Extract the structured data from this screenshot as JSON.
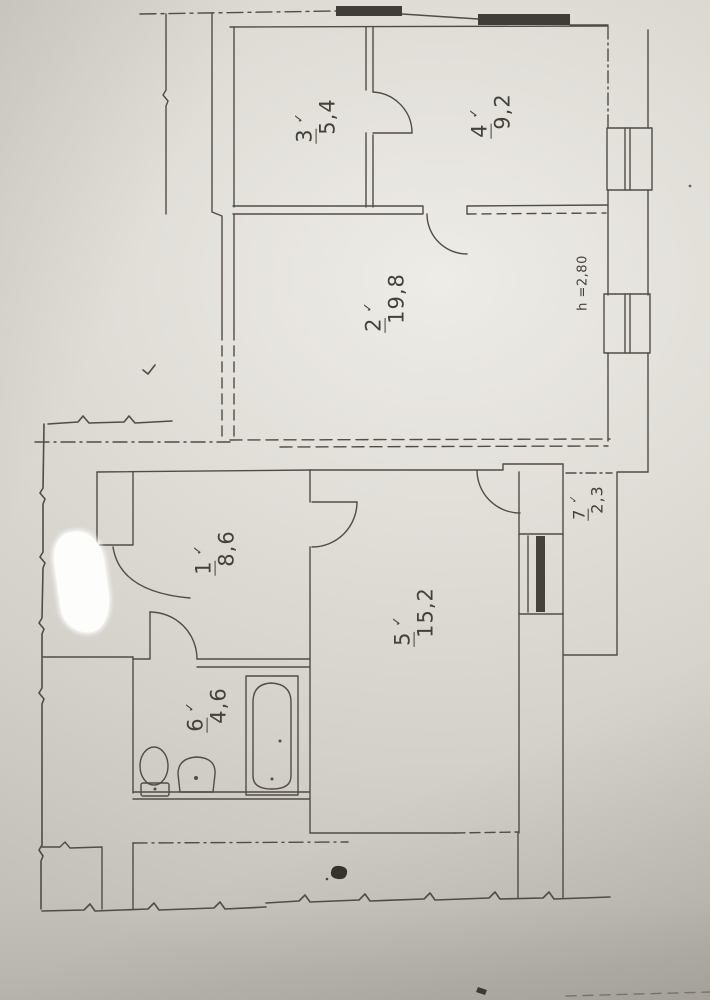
{
  "rooms": [
    {
      "number": "1",
      "check": "✓",
      "area": "8,6"
    },
    {
      "number": "2",
      "check": "✓",
      "area": "19,8"
    },
    {
      "number": "3",
      "check": "✓",
      "area": "5,4"
    },
    {
      "number": "4",
      "check": "✓",
      "area": "9,2"
    },
    {
      "number": "5",
      "check": "✓",
      "area": "15,2"
    },
    {
      "number": "6",
      "check": "✓",
      "area": "4,6"
    },
    {
      "number": "7",
      "check": "✓",
      "area": "2,3"
    }
  ],
  "annotations": {
    "ceiling_height": "h =2,80"
  },
  "colors": {
    "paper": "#dfdcd6",
    "ink": "#514c45",
    "ink_dark": "#403c37",
    "whiteout": "#fdfdfc"
  }
}
